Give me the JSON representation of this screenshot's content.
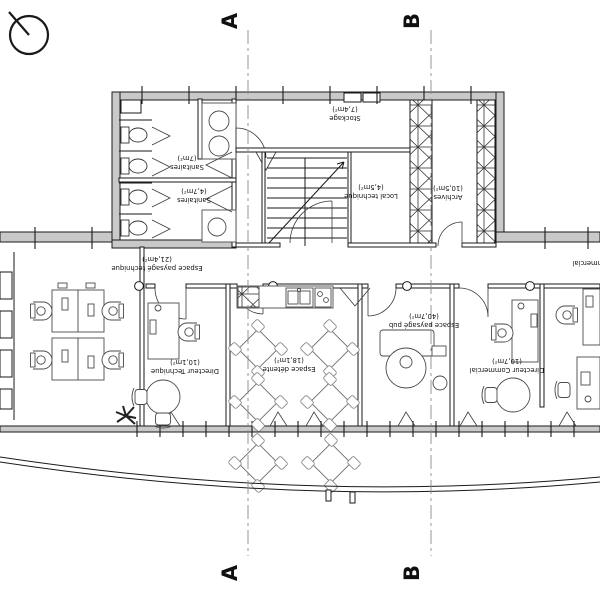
{
  "drawing": {
    "type": "architectural floor plan (office level), labels drawn rotated 180°",
    "colors": {
      "wall_fill": "#c9c9c9",
      "line": "#1a1a1a",
      "section_line": "#8a8a8a",
      "background": "#ffffff"
    },
    "icons": [
      "north-arrow-icon"
    ]
  },
  "section_markers": {
    "a_top": "A",
    "a_bottom": "A",
    "b_top": "B",
    "b_bottom": "B"
  },
  "rooms": [
    {
      "id": "sanitaires_1",
      "name": "Sanitaires",
      "area": "(7m²)"
    },
    {
      "id": "sanitaires_2",
      "name": "Sanitaires",
      "area": "(4,7m²)"
    },
    {
      "id": "stockage",
      "name": "Stockage",
      "area": "(7,4m²)"
    },
    {
      "id": "local_technique",
      "name": "Local technique",
      "area": "(4,5m²)"
    },
    {
      "id": "archives",
      "name": "Archives",
      "area": "(10,5m²)"
    },
    {
      "id": "espace_paysage_technique",
      "name": "Espace paysagé technique",
      "area": "(21,4m²)"
    },
    {
      "id": "directeur_technique",
      "name": "Directeur Technique",
      "area": "(10,1m²)"
    },
    {
      "id": "espace_detente",
      "name": "Espace détente",
      "area": "(18,1m²)"
    },
    {
      "id": "espace_paysage_pub",
      "name": "Espace paysagé pub",
      "area": "(40,7m²)"
    },
    {
      "id": "directeur_commercial",
      "name": "Directeur Commercial",
      "area": "(10,7m²)"
    },
    {
      "id": "espace_paysage_commercial_partial",
      "name": "Espace paysagé commercial",
      "area": ""
    }
  ]
}
